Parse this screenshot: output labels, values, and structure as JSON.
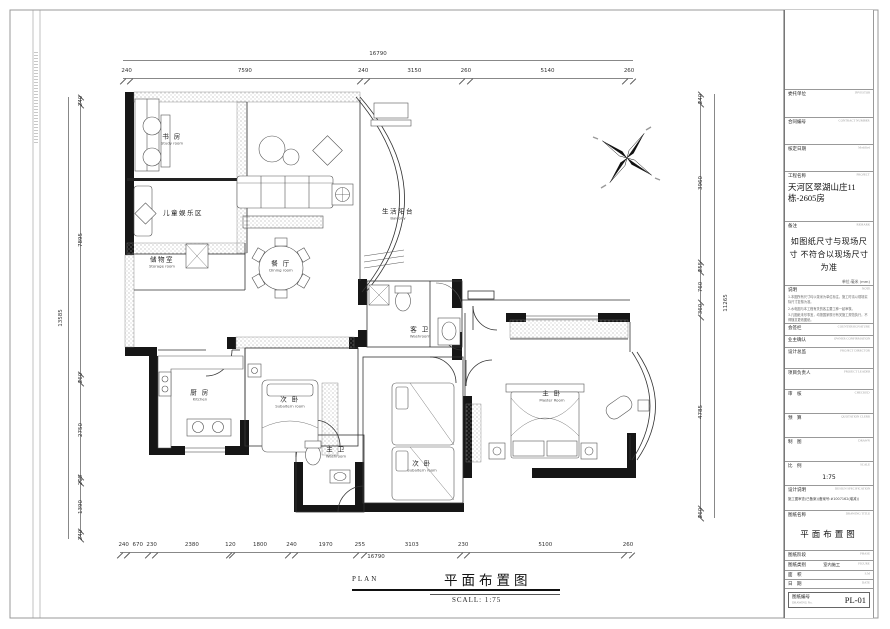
{
  "colors": {
    "wall": "#161616",
    "line": "#333333",
    "dim": "#555555"
  },
  "icons": {
    "compass": "north-compass"
  },
  "plan": {
    "rooms": {
      "study": {
        "cn": "书 房",
        "en": "Study room"
      },
      "kids": {
        "cn": "儿童娱乐区"
      },
      "storage": {
        "cn": "储物室",
        "en": "Storage room"
      },
      "dining": {
        "cn": "餐 厅",
        "en": "Dining room"
      },
      "balcony": {
        "cn": "生活阳台",
        "en": "Balcony"
      },
      "kitchen": {
        "cn": "厨 房",
        "en": "Kitchen"
      },
      "bedroom1": {
        "cn": "次 卧",
        "en": "Subaltern room"
      },
      "bedroom2": {
        "cn": "次 卧",
        "en": "Subaltern room"
      },
      "master": {
        "cn": "主 卧",
        "en": "Master Room"
      },
      "bath_guest": {
        "cn": "客 卫",
        "en": "Washroom"
      },
      "bath_master": {
        "cn": "主 卫",
        "en": "Washroom"
      }
    }
  },
  "dimensions": {
    "top": {
      "total": "16790",
      "segments": [
        240,
        7590,
        240,
        3150,
        260,
        5140,
        260
      ]
    },
    "bottom": {
      "total": "16790",
      "segments": [
        240,
        670,
        230,
        2380,
        120,
        1800,
        240,
        1970,
        255,
        3103,
        230,
        5100,
        260
      ]
    },
    "left": {
      "total": "13585",
      "segments": [
        240,
        7895,
        260,
        2750,
        205,
        1390,
        240
      ]
    },
    "right": {
      "total": "11265",
      "segments": [
        240,
        3960,
        255,
        760,
        360,
        4785,
        260
      ]
    }
  },
  "title_block": {
    "rows": {
      "investor": {
        "cn": "委托单位",
        "en": "INVESTOR"
      },
      "contract": {
        "cn": "合同编号",
        "en": "CONTRACT NUMBER"
      },
      "modified": {
        "cn": "核定日期",
        "en": "Modified"
      },
      "project": {
        "cn": "工程名称",
        "en": "PROJECT",
        "value": "天河区翠湖山庄11栋-2605房"
      },
      "remark": {
        "cn": "备注",
        "en": "REMARK",
        "text": "如图纸尺寸与现场尺寸 不符合以现场尺寸为准",
        "unit": "单位:毫米 (mm)"
      },
      "note": {
        "cn": "说明",
        "en": "NOTE",
        "lines": [
          "1.本图所有尺寸均以毫米为单位标注，施工时请以现场实际尺寸复核为准。",
          "2.水电图与本工程有关的各主要工种一起审核。",
          "3.凡图纸未尽事宜，均按国家现行有关施工规范执行，不得随意更改图纸。"
        ]
      },
      "countersign": {
        "cn": "会签栏",
        "en": "COUNTERSIGNATURE"
      },
      "owner": {
        "cn": "业主确认",
        "en": "OWNER CONFIRMATION"
      },
      "director": {
        "cn": "设计总监",
        "en": "PROJECT DIRECTOR"
      },
      "leader": {
        "cn": "项目负责人",
        "en": "PROJECT LEADER"
      },
      "checked": {
        "cn": "审　核",
        "en": "CHECKED"
      },
      "quotation": {
        "cn": "预　算",
        "en": "QUOTATION CLERK"
      },
      "drawn": {
        "cn": "制　图",
        "en": "DRAWN"
      },
      "scale": {
        "cn": "比　例",
        "en": "SCALE",
        "value": "1:75"
      },
      "design_spec": {
        "cn": "设计说明",
        "en": "DESIGN SPECIFICATION",
        "value": "施工图审查(已备案)(备案号:#1007162(增减))"
      },
      "drawing_title": {
        "cn": "图纸名称",
        "en": "DRAWING TITLE",
        "value": "平面布置图"
      },
      "phase": {
        "cn": "图纸阶段",
        "en": "PHASE"
      },
      "category": {
        "cn": "图纸类别",
        "value": "室内施工",
        "en": "FIGURE"
      },
      "area": {
        "cn": "面　积",
        "en": "S.M"
      },
      "date": {
        "cn": "日　期",
        "en": "DATE"
      },
      "number": {
        "cn": "图纸编号",
        "en": "DRAWING No.",
        "value": "PL-01"
      }
    }
  },
  "footer": {
    "plan_label": "PLAN",
    "title": "平面布置图",
    "scale": "SCALL:  1:75"
  }
}
